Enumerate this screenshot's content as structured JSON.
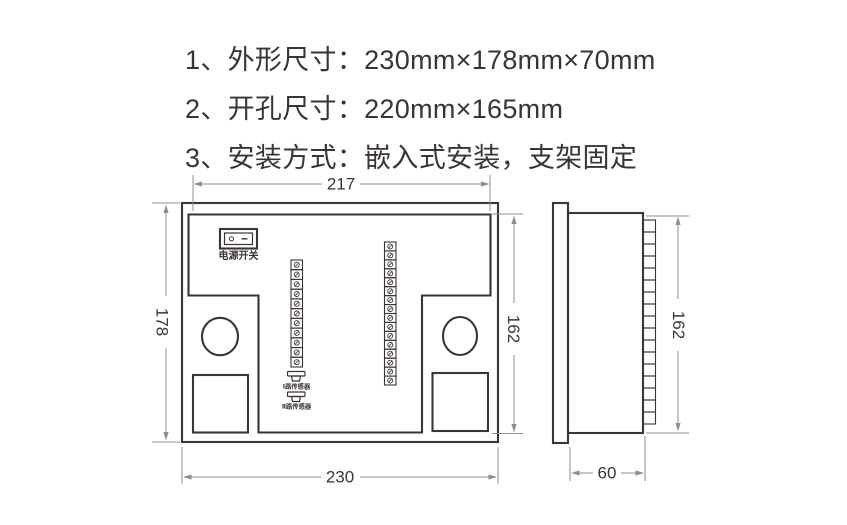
{
  "specs": [
    {
      "text": "1、外形尺寸：230mm×178mm×70mm"
    },
    {
      "text": "2、开孔尺寸：220mm×165mm"
    },
    {
      "text": "3、安装方式：嵌入式安装，支架固定"
    }
  ],
  "rear_view": {
    "power_switch_label": "电源开关",
    "power_switch_symbols": {
      "off": "○",
      "on": "—"
    },
    "sensor_channel_1_label": "Ⅰ路传感器",
    "sensor_channel_2_label": "Ⅱ路传感器",
    "dimensions": {
      "top_width": "217",
      "left_height": "178",
      "right_height": "162",
      "bottom_width": "230"
    },
    "terminal_counts": {
      "left_strip": 11,
      "right_strip": 16
    }
  },
  "side_view": {
    "dimensions": {
      "height": "162",
      "depth": "60"
    },
    "terminal_count": 17
  },
  "colors": {
    "drawing_line": "#3a3432",
    "dimension_line": "#8f8f8f",
    "text": "#3a3432",
    "background": "#ffffff"
  }
}
